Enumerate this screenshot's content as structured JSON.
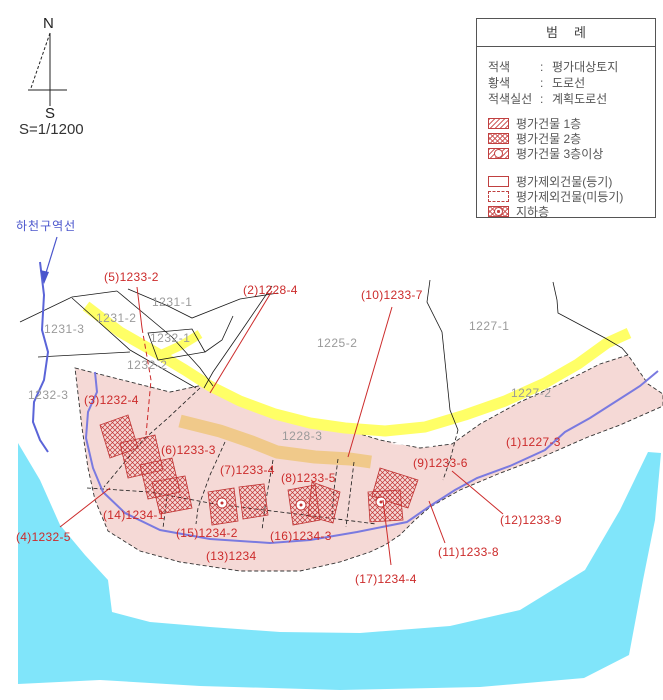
{
  "scale_text": "S=1/1200",
  "compass": {
    "north": "N",
    "south": "S"
  },
  "river_zone_label": "하천구역선",
  "legend": {
    "title": "범례",
    "color_rows": [
      {
        "term": "적색",
        "colon": ":",
        "desc": "평가대상토지"
      },
      {
        "term": "황색",
        "colon": ":",
        "desc": "도로선"
      },
      {
        "term": "적색실선",
        "colon": ":",
        "desc": "계획도로선"
      }
    ],
    "swatch_rows": [
      {
        "pattern": "diagonal-hatch",
        "label": "평가건물 1층"
      },
      {
        "pattern": "crosshatch",
        "label": "평가건물 2층"
      },
      {
        "pattern": "hatch-circle",
        "label": "평가건물 3층이상"
      },
      {
        "pattern": "outline",
        "label": "평가제외건물(등기)"
      },
      {
        "pattern": "dashed-outline",
        "label": "평가제외건물(미등기)"
      },
      {
        "pattern": "crosshatch-circle",
        "label": "지하층"
      }
    ]
  },
  "map": {
    "red_labels": [
      {
        "text": "(5)1233-2"
      },
      {
        "text": "(2)1228-4"
      },
      {
        "text": "(10)1233-7"
      },
      {
        "text": "(1)1227-3"
      },
      {
        "text": "(3)1232-4"
      },
      {
        "text": "(6)1233-3"
      },
      {
        "text": "(7)1233-4"
      },
      {
        "text": "(8)1233-5"
      },
      {
        "text": "(9)1233-6"
      },
      {
        "text": "(14)1234-1"
      },
      {
        "text": "(4)1232-5"
      },
      {
        "text": "(15)1234-2"
      },
      {
        "text": "(16)1234-3"
      },
      {
        "text": "(13)1234"
      },
      {
        "text": "(17)1234-4"
      },
      {
        "text": "(11)1233-8"
      },
      {
        "text": "(12)1233-9"
      }
    ],
    "gray_labels": [
      {
        "text": "1231-1"
      },
      {
        "text": "1231-2"
      },
      {
        "text": "1231-3"
      },
      {
        "text": "1232-1"
      },
      {
        "text": "1232-2"
      },
      {
        "text": "1232-3"
      },
      {
        "text": "1225-2"
      },
      {
        "text": "1227-1"
      },
      {
        "text": "1227-2"
      },
      {
        "text": "1228-3"
      }
    ]
  },
  "colors": {
    "evaluation_area_pink": "#f5d9d6",
    "road_yellow": "#ffff66",
    "road_orange": "#f0c98a",
    "water_cyan": "#80e5fa",
    "river_blue": "#7a7ae0",
    "river_zone_blue": "#4a55cc",
    "label_red": "#cc2b2b",
    "label_gray": "#9a9a9a",
    "boundary_black": "#1a1a1a"
  }
}
